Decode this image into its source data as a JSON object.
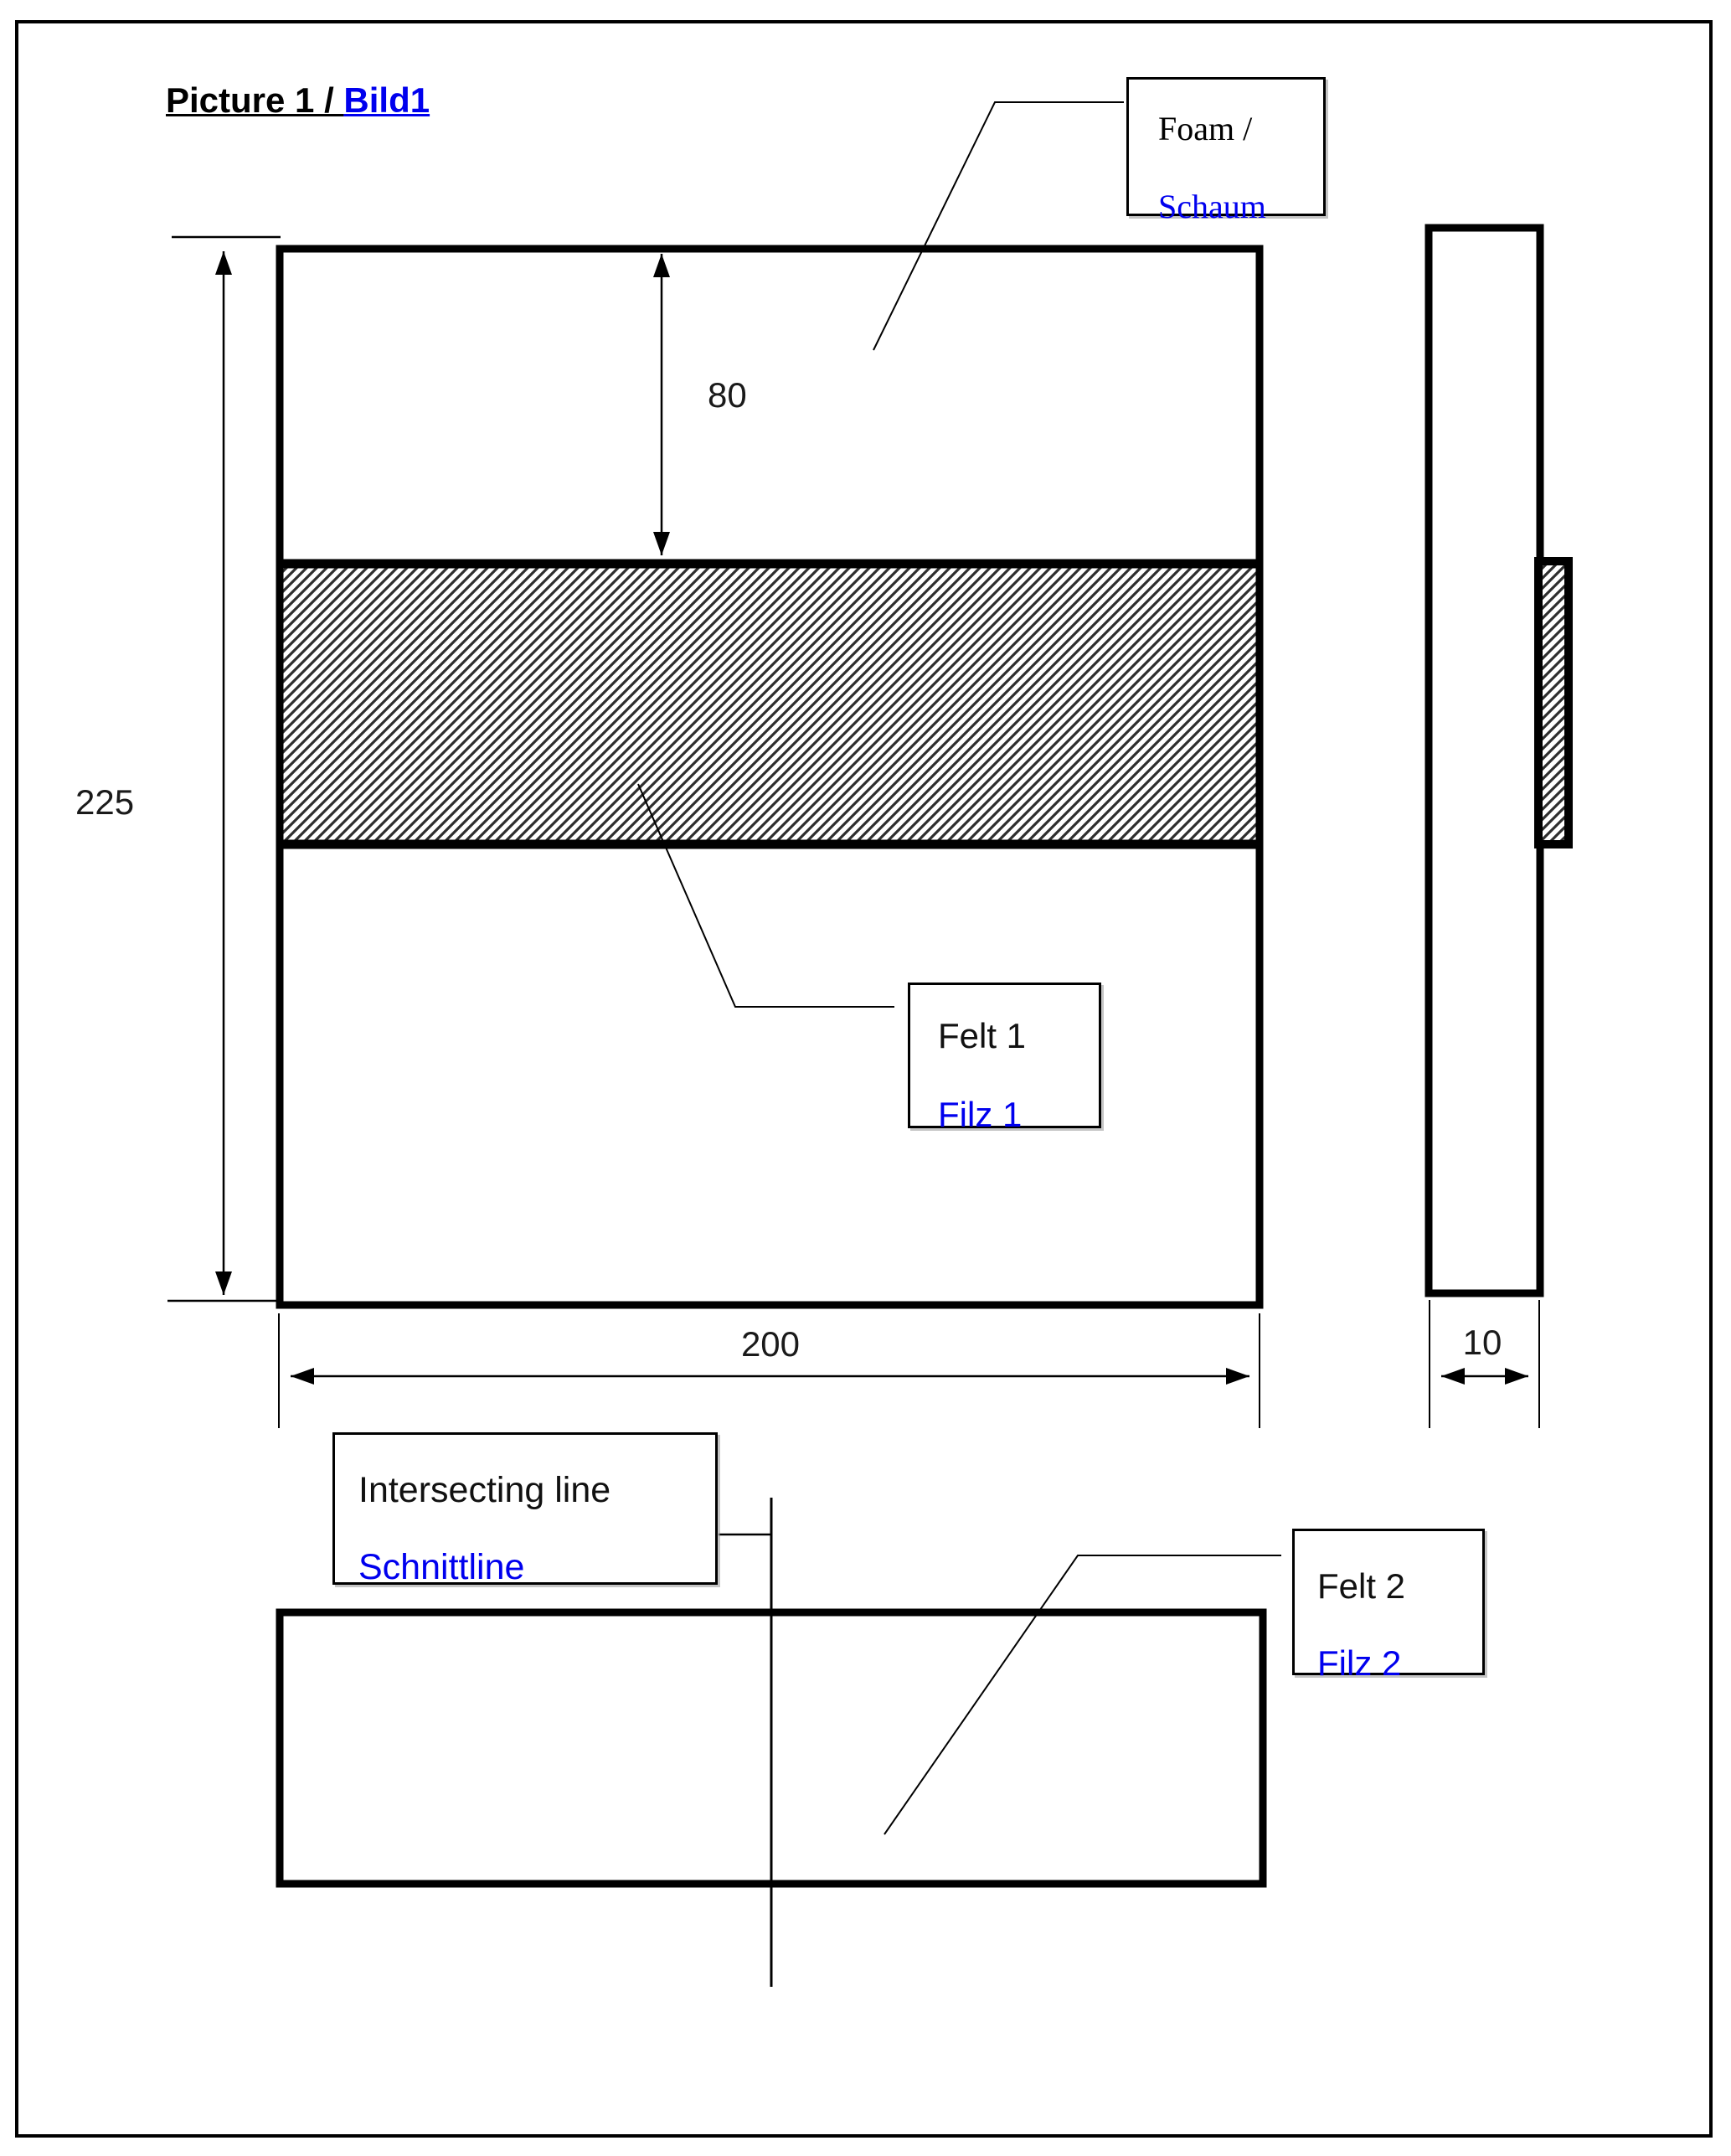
{
  "title": {
    "primary": "Picture 1 / ",
    "secondary": "Bild1"
  },
  "labels": {
    "foam": {
      "en": "Foam /",
      "de": "Schaum"
    },
    "felt1": {
      "en": "Felt 1",
      "de": "Filz 1"
    },
    "intersecting": {
      "en": "Intersecting line",
      "de": "Schnittline"
    },
    "felt2": {
      "en": "Felt 2",
      "de": "Filz 2"
    }
  },
  "dimensions": {
    "total_height": "225",
    "foam_band_offset": "80",
    "width": "200",
    "thickness": "10"
  },
  "colors": {
    "accent_blue": "#0000EE",
    "line_black": "#000000"
  }
}
